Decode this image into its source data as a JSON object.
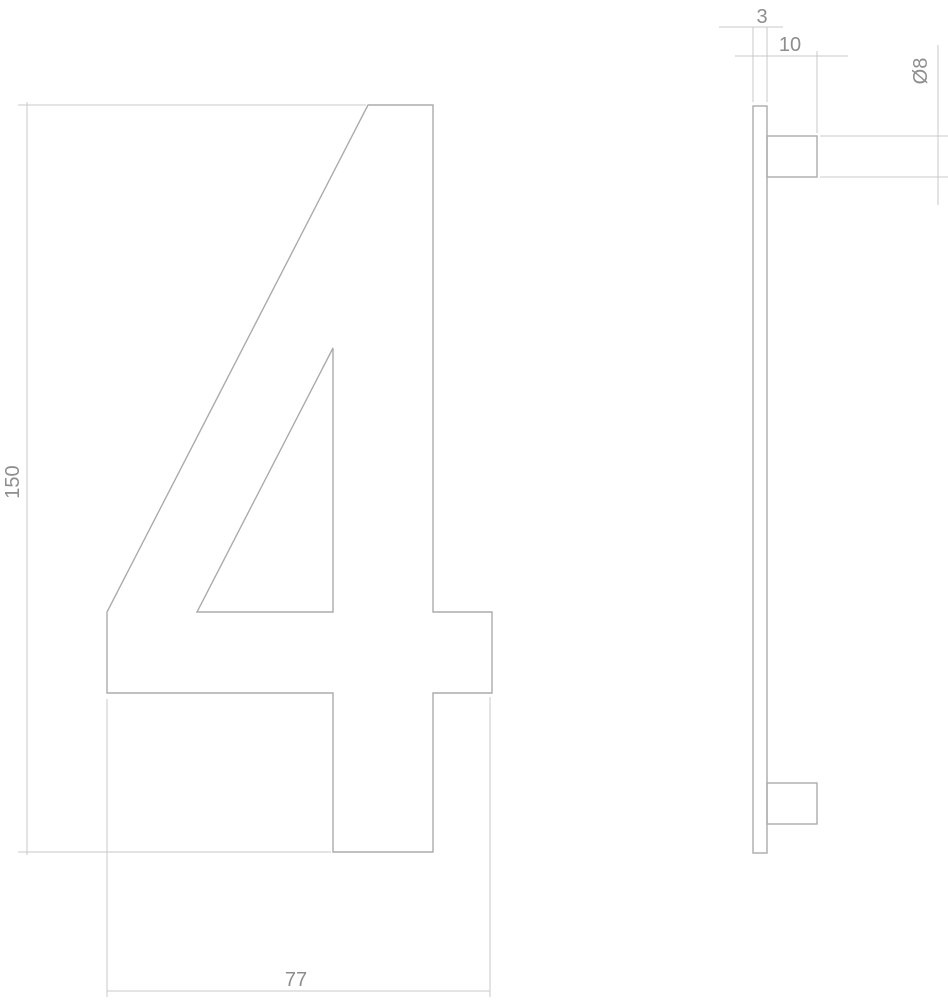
{
  "drawing": {
    "numeral": "4",
    "front_view": {
      "height": {
        "value": 150,
        "label": "150"
      },
      "width": {
        "value": 77,
        "label": "77"
      }
    },
    "side_view": {
      "thickness": {
        "value": 3,
        "label": "3"
      },
      "peg_length": {
        "value": 10,
        "label": "10"
      },
      "peg_diameter": {
        "value": 8,
        "label": "Ø8"
      }
    }
  },
  "colors": {
    "background": "#ffffff",
    "part_line": "#ababab",
    "dimension_line": "#c8c8c8",
    "label_text": "#8e8e8e"
  }
}
